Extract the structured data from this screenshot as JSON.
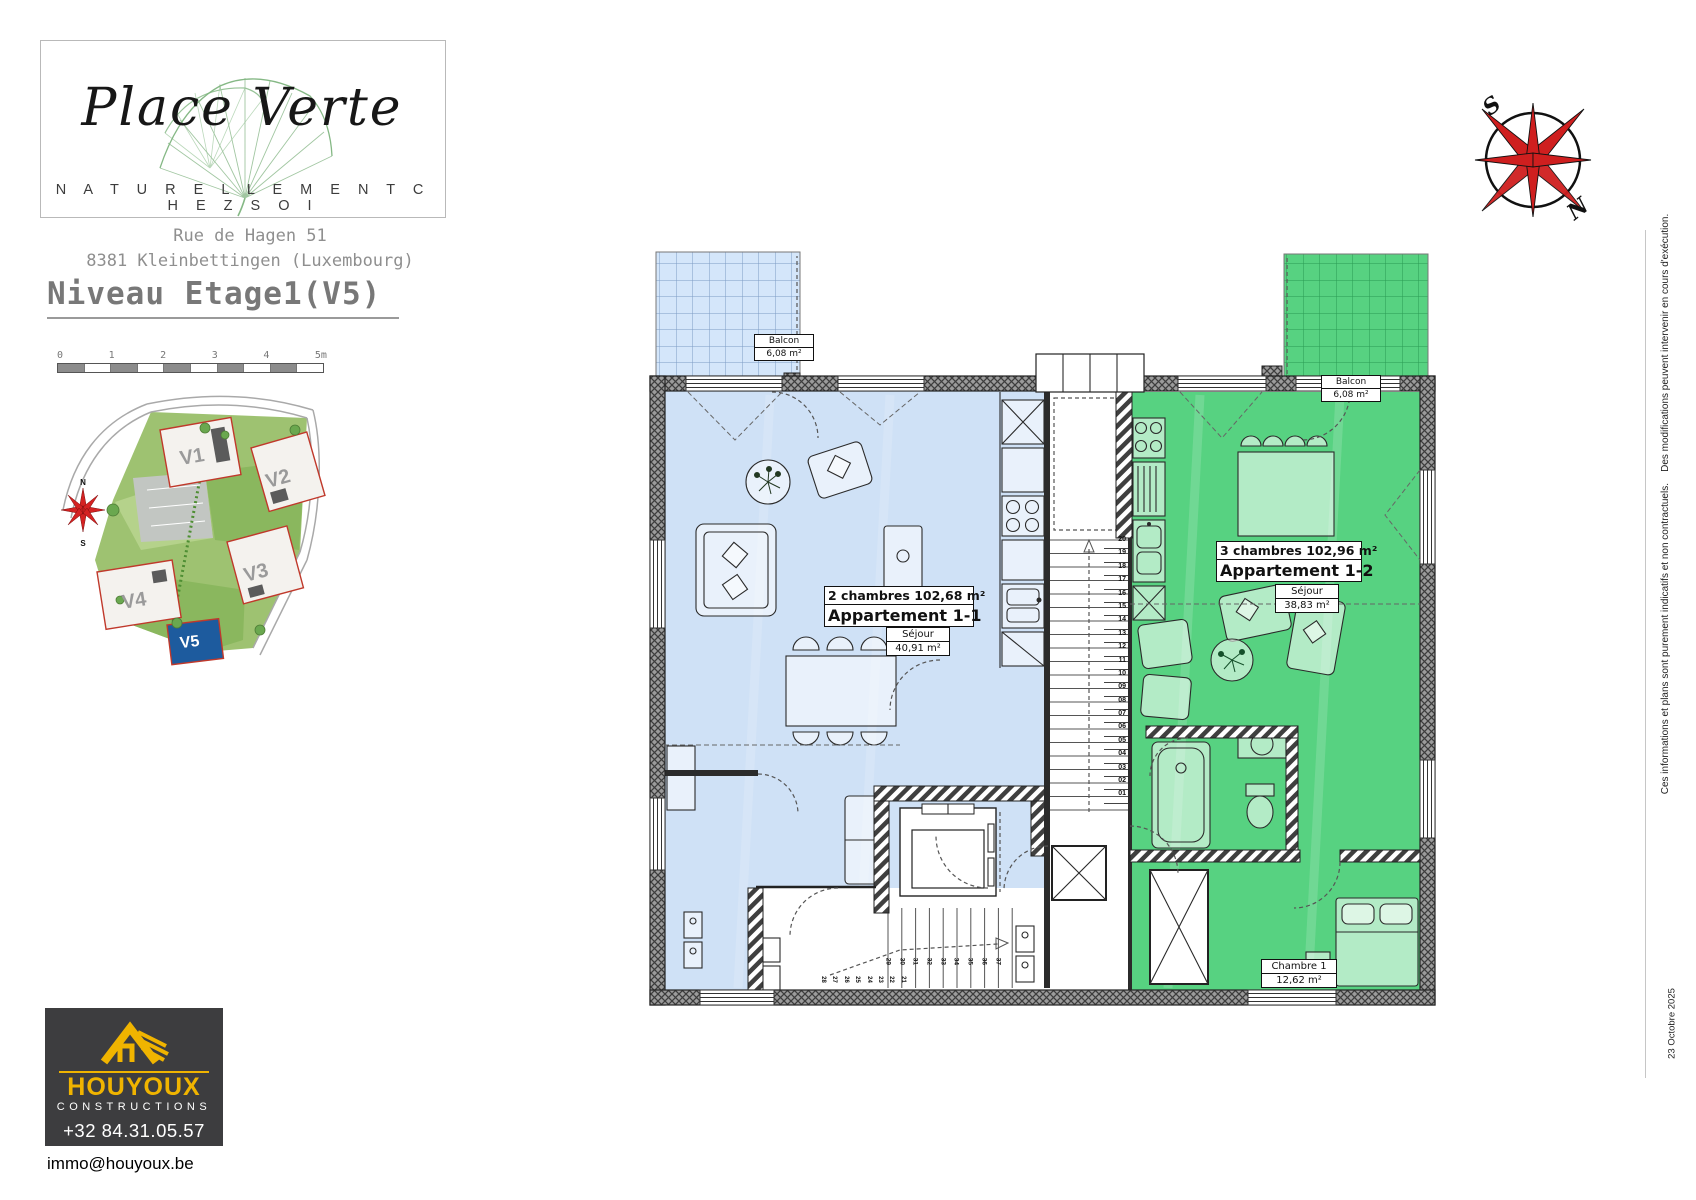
{
  "branding": {
    "project_name": "Place Verte",
    "tagline": "N A T U R E L L E M E N T   C H E Z   S O I",
    "address_line1": "Rue de Hagen 51",
    "address_line2": "8381 Kleinbettingen (Luxembourg)"
  },
  "sheet": {
    "title": "Niveau Etage1(V5)",
    "date": "23 Octobre 2025",
    "disclaimer": "Ces informations et plans sont purement indicatifs et non contractuels.    Des modifications peuvent intervenir en cours d'exécution."
  },
  "scale_bar": {
    "labels": [
      "0",
      "1",
      "2",
      "3",
      "4",
      "5m"
    ]
  },
  "site_plan": {
    "buildings": [
      "V1",
      "V2",
      "V3",
      "V4",
      "V5"
    ],
    "highlighted": "V5",
    "compass_north": "N",
    "compass_south": "S"
  },
  "compass": {
    "north_label": "N",
    "south_label": "S"
  },
  "floor_plan": {
    "apartments": [
      {
        "rooms_line": "2 chambres  102,68 m²",
        "name_line": "Appartement 1-1",
        "sejour_label": "Séjour",
        "sejour_area": "40,91 m²",
        "balcon_label": "Balcon",
        "balcon_area": "6,08 m²",
        "fill_color": "#cfe1f6"
      },
      {
        "rooms_line": "3 chambres  102,96 m²",
        "name_line": "Appartement 1-2",
        "sejour_label": "Séjour",
        "sejour_area": "38,83 m²",
        "balcon_label": "Balcon",
        "balcon_area": "6,08 m²",
        "chambre_label": "Chambre 1",
        "chambre_area": "12,62 m²",
        "fill_color": "#57d281"
      }
    ],
    "stairs": {
      "corridor_numbers": [
        "20",
        "19",
        "18",
        "17",
        "16",
        "15",
        "14",
        "13",
        "12",
        "11",
        "10",
        "09",
        "08",
        "07",
        "06",
        "05",
        "04",
        "03",
        "02",
        "01"
      ],
      "upper_run": [
        "29",
        "30",
        "31",
        "32",
        "33",
        "34",
        "35",
        "36",
        "37"
      ],
      "lower_run": [
        "28",
        "27",
        "26",
        "25",
        "24",
        "23",
        "22",
        "21"
      ]
    }
  },
  "builder": {
    "name": "HOUYOUX",
    "subtitle": "CONSTRUCTIONS",
    "phone": "+32 84.31.05.57",
    "email": "immo@houyoux.be",
    "accent_color": "#f0b400"
  }
}
